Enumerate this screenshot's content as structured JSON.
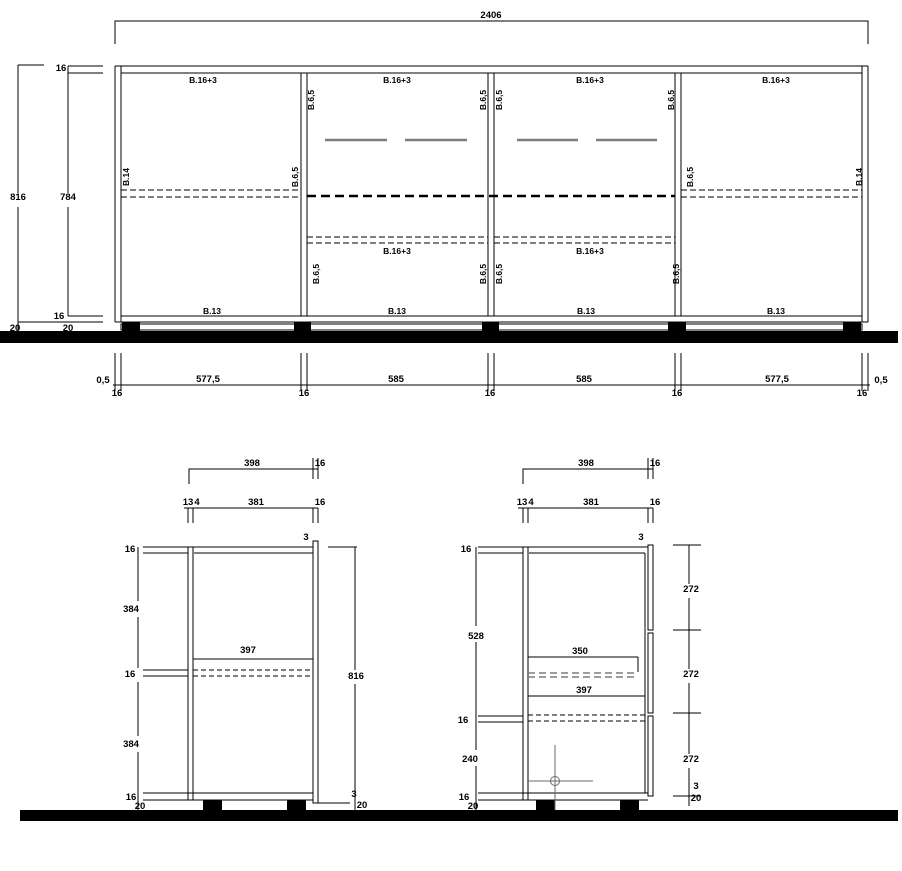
{
  "colors": {
    "line": "#000000",
    "handle_gray": "#7d7d7d",
    "crosshair_gray": "#6a6a6a",
    "floor": "#000000"
  },
  "front_view": {
    "overall_width": "2406",
    "total_height": "816",
    "inner_height": "784",
    "top_panel": "16",
    "bottom_panel": "16",
    "foot_height_a": "20",
    "foot_height_b": "20",
    "bay_top": [
      "B.16+3",
      "B.16+3",
      "B.16+3",
      "B.16+3"
    ],
    "shelf_mid": [
      "B.16+3",
      "B.16+3"
    ],
    "bottom_labels": [
      "B.13",
      "B.13",
      "B.13",
      "B.13"
    ],
    "side_labels": [
      "B.14",
      "B.14"
    ],
    "partition_labels": [
      "B.6,5",
      "B.6,5",
      "B.6,5",
      "B.6,5",
      "B.6,5",
      "B.6,5",
      "B.6,5",
      "B.6,5",
      "B.6,5",
      "B.6,5"
    ],
    "width_dims": {
      "gap_left": "0,5",
      "gap_right": "0,5",
      "bay_widths": [
        "577,5",
        "585",
        "585",
        "577,5"
      ],
      "panel_16": [
        "16",
        "16",
        "16",
        "16",
        "16"
      ]
    }
  },
  "section_a": {
    "depth_total": "398",
    "door_thickness": "16",
    "back_gap": "13",
    "back_panel": "4",
    "inner_depth": "381",
    "door_thickness_2": "16",
    "door_overhang_top": "3",
    "top_panel": "16",
    "upper_height": "384",
    "shelf_thickness": "16",
    "lower_height": "384",
    "bottom_panel": "16",
    "foot_height": "20",
    "shelf_depth": "397",
    "total_height": "816",
    "door_overhang_bottom": "3",
    "foot_height_right": "20"
  },
  "section_b": {
    "depth_total": "398",
    "door_thickness": "16",
    "back_gap": "13",
    "back_panel": "4",
    "inner_depth": "381",
    "door_thickness_2": "16",
    "door_overhang_top": "3",
    "top_panel": "16",
    "upper_height": "528",
    "mid_panel": "16",
    "lower_height": "240",
    "bottom_panel": "16",
    "foot_height": "20",
    "drawer_depth": "350",
    "shelf_depth": "397",
    "front_heights": [
      "272",
      "272",
      "272"
    ],
    "door_overhang_bottom": "3",
    "foot_height_right": "20"
  }
}
